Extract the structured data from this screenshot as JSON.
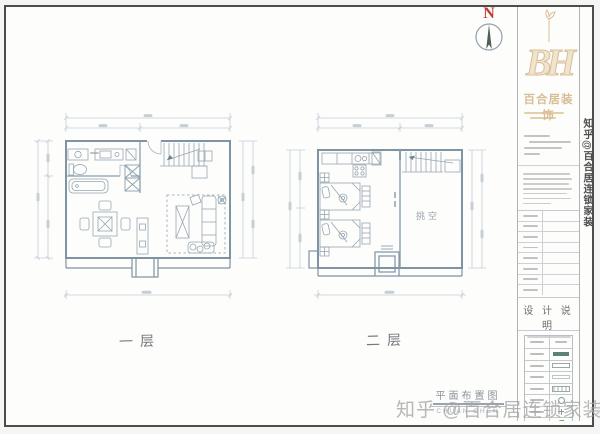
{
  "north_indicator": {
    "label": "N"
  },
  "plans": {
    "floor1": {
      "caption": "一层"
    },
    "floor2": {
      "caption": "二层",
      "void_label": "挑空"
    }
  },
  "caption": {
    "title": "平面布置图",
    "subtitle": "CHUAN CHEN"
  },
  "title_block": {
    "logo_monogram": "BH",
    "company_name": "百合居装饰",
    "design_note_title": "设 计 说 明"
  },
  "watermark": {
    "bottom_text": "知乎 @百合居连锁家装",
    "side_text": "知乎@百合居连锁家装"
  },
  "colors": {
    "brand_tan": "#d8bd97",
    "north_red": "#c23b2a",
    "compass_needle": "#4a6157",
    "legend_teal": "#5c8176",
    "legend_green": "#6fae4f",
    "wall_line": "#7e93a3",
    "furniture_line": "#96a6b2",
    "dimension_line": "#c6cfd6"
  }
}
